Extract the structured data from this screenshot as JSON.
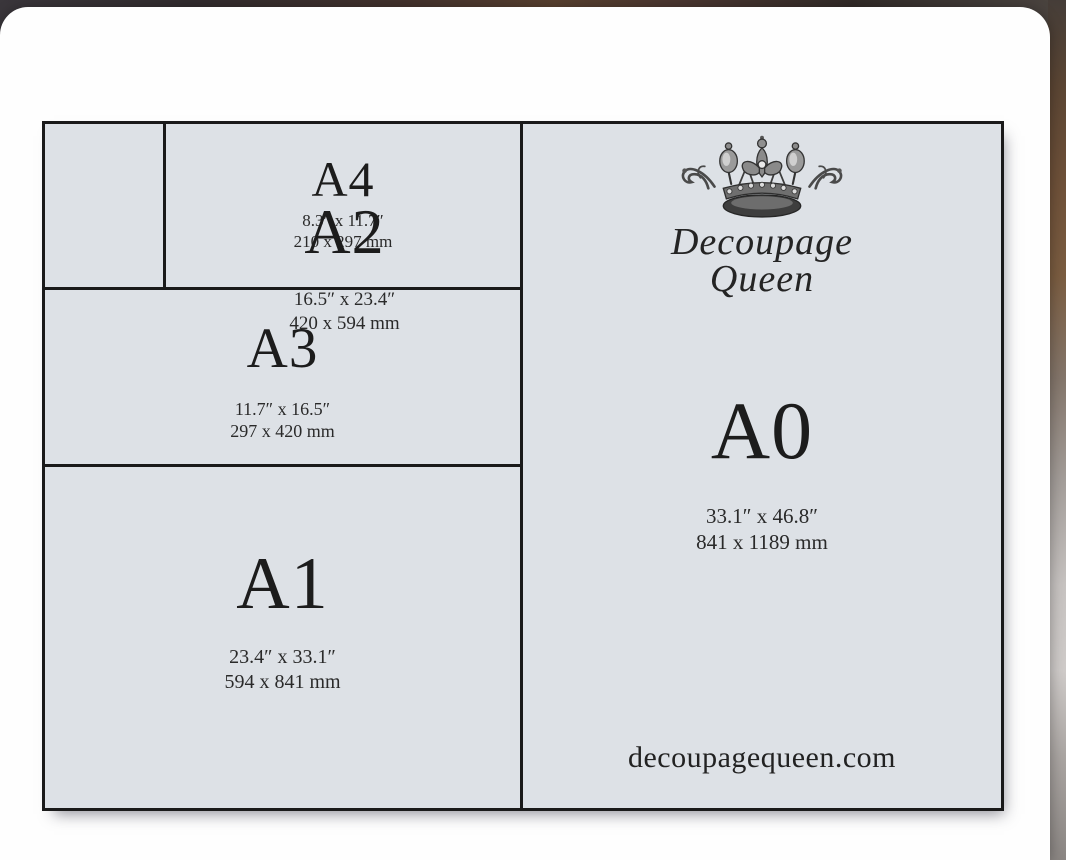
{
  "brand": {
    "logo_line1": "Decoupage",
    "logo_line2": "Queen",
    "website": "decoupagequeen.com"
  },
  "sizes": {
    "a4": {
      "label": "A4",
      "inches": "8.3″ x 11.7″",
      "mm": "210 x 297 mm"
    },
    "a3": {
      "label": "A3",
      "inches": "11.7″ x 16.5″",
      "mm": "297 x 420 mm"
    },
    "a2": {
      "label": "A2",
      "inches": "16.5″ x 23.4″",
      "mm": "420 x 594 mm"
    },
    "a1": {
      "label": "A1",
      "inches": "23.4″ x 33.1″",
      "mm": "594 x 841 mm"
    },
    "a0": {
      "label": "A0",
      "inches": "33.1″ x 46.8″",
      "mm": "841 x 1189 mm"
    }
  },
  "colors": {
    "paper_bg": "#dde1e6",
    "grid_line": "#1a1a1a",
    "card_bg": "#fefefe",
    "text": "#1c1c1c"
  }
}
